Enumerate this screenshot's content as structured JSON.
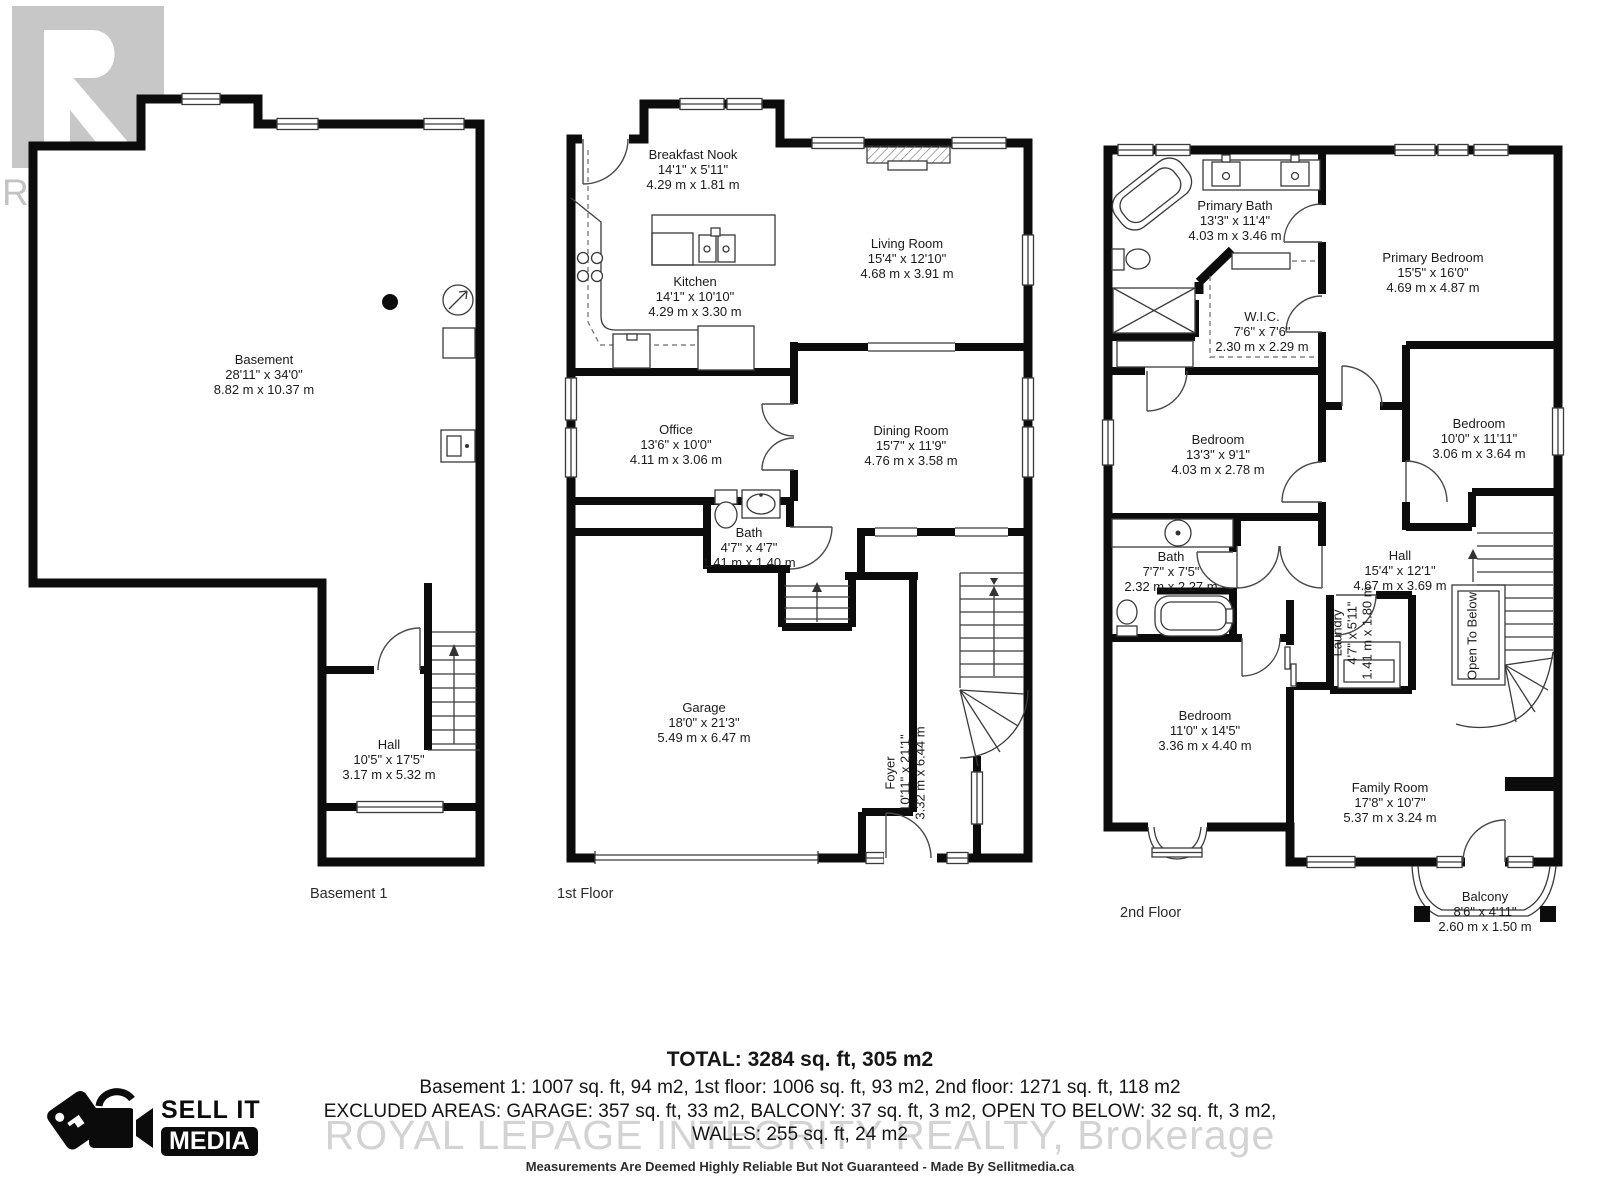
{
  "watermarks": {
    "realtor_logo_text": "REALTOR",
    "registered": "®",
    "brokerage": "ROYAL LEPAGE INTEGRITY REALTY,  Brokerage"
  },
  "vendor_logo": {
    "line1": "SELL IT",
    "line2": "MEDIA"
  },
  "floors": [
    {
      "label": "Basement 1",
      "rooms": [
        {
          "name": "Basement",
          "imperial": "28'11\" x 34'0\"",
          "metric": "8.82 m x 10.37 m"
        },
        {
          "name": "Hall",
          "imperial": "10'5\" x 17'5\"",
          "metric": "3.17 m x 5.32 m"
        }
      ]
    },
    {
      "label": "1st Floor",
      "rooms": [
        {
          "name": "Breakfast Nook",
          "imperial": "14'1\" x 5'11\"",
          "metric": "4.29 m x 1.81 m"
        },
        {
          "name": "Kitchen",
          "imperial": "14'1\" x 10'10\"",
          "metric": "4.29 m x 3.30 m"
        },
        {
          "name": "Living Room",
          "imperial": "15'4\" x 12'10\"",
          "metric": "4.68 m x 3.91 m"
        },
        {
          "name": "Office",
          "imperial": "13'6\" x 10'0\"",
          "metric": "4.11 m x 3.06 m"
        },
        {
          "name": "Dining Room",
          "imperial": "15'7\" x 11'9\"",
          "metric": "4.76 m x 3.58 m"
        },
        {
          "name": "Bath",
          "imperial": "4'7\" x 4'7\"",
          "metric": "1.41 m x 1.40 m"
        },
        {
          "name": "Garage",
          "imperial": "18'0\" x 21'3\"",
          "metric": "5.49 m x 6.47 m"
        },
        {
          "name": "Foyer",
          "imperial": "10'11\" x 21'1\"",
          "metric": "3.32 m x 6.44 m"
        }
      ]
    },
    {
      "label": "2nd Floor",
      "rooms": [
        {
          "name": "Primary Bath",
          "imperial": "13'3\" x 11'4\"",
          "metric": "4.03 m x 3.46 m"
        },
        {
          "name": "W.I.C.",
          "imperial": "7'6\" x 7'6\"",
          "metric": "2.30 m x 2.29 m"
        },
        {
          "name": "Primary Bedroom",
          "imperial": "15'5\" x 16'0\"",
          "metric": "4.69 m x 4.87 m"
        },
        {
          "name": "Bedroom",
          "imperial": "13'3\" x 9'1\"",
          "metric": "4.03 m x 2.78 m"
        },
        {
          "name": "Bedroom",
          "imperial": "10'0\" x 11'11\"",
          "metric": "3.06 m x 3.64 m"
        },
        {
          "name": "Bath",
          "imperial": "7'7\" x 7'5\"",
          "metric": "2.32 m x 2.27 m"
        },
        {
          "name": "Hall",
          "imperial": "15'4\" x 12'1\"",
          "metric": "4.67 m x 3.69 m"
        },
        {
          "name": "Laundry",
          "imperial": "4'7\" x 5'11\"",
          "metric": "1.41 m x 1.80 m"
        },
        {
          "name": "Open To Below"
        },
        {
          "name": "Bedroom",
          "imperial": "11'0\" x 14'5\"",
          "metric": "3.36 m x 4.40 m"
        },
        {
          "name": "Family Room",
          "imperial": "17'8\" x 10'7\"",
          "metric": "5.37 m x 3.24 m"
        },
        {
          "name": "Balcony",
          "imperial": "8'6\" x 4'11\"",
          "metric": "2.60 m x 1.50 m"
        }
      ]
    }
  ],
  "summary": {
    "total": "TOTAL: 3284 sq. ft, 305 m2",
    "floors_line": "Basement 1: 1007 sq. ft, 94 m2, 1st floor: 1006 sq. ft, 93 m2, 2nd floor: 1271 sq. ft, 118 m2",
    "excluded_line": "EXCLUDED AREAS: GARAGE: 357 sq. ft, 33 m2, BALCONY: 37 sq. ft, 3 m2, OPEN TO BELOW: 32 sq. ft, 3 m2,",
    "walls_line": "WALLS: 255 sq. ft, 24 m2",
    "disclaimer": "Measurements Are Deemed Highly Reliable But Not Guaranteed - Made By Sellitmedia.ca"
  }
}
